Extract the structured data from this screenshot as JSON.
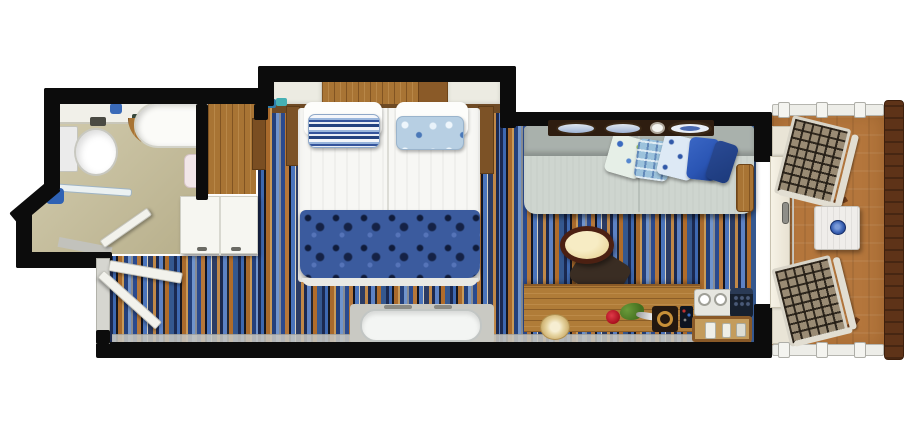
{
  "title": "Balcony stateroom floor plan",
  "rooms": [
    {
      "id": "bathroom",
      "label": "Bathroom"
    },
    {
      "id": "closet",
      "label": "Closet and wardrobe"
    },
    {
      "id": "entry",
      "label": "Entry hallway"
    },
    {
      "id": "bedroom",
      "label": "Bedroom with twin beds"
    },
    {
      "id": "sitting_area",
      "label": "Sitting area"
    },
    {
      "id": "balcony",
      "label": "Private balcony"
    }
  ],
  "labels": {
    "floor_plan": "Stateroom floor plan",
    "bathroom": "Bathroom",
    "sink_counter": "Sink counter",
    "faucet": "Faucet",
    "bathtub": "Bathtub shower",
    "toilet": "Toilet",
    "towel": "Towel",
    "shower_screen": "Glass shower screen",
    "shower_head": "Shower head",
    "bathroom_door": "Bathroom door",
    "closet_floor": "Closet wood floor",
    "wardrobe": "Wardrobe cabinet",
    "entry": "Entry hallway",
    "entry_door": "Entry door",
    "bedroom": "Bedroom",
    "bed": "Twin beds with duvet",
    "headboard": "Wood headboard",
    "shelf": "Bedside shelf",
    "nightstand": "Nightstand",
    "pillow_striped": "Striped pillow",
    "pillow_floral": "Floral pillow",
    "bed_runner": "Patterned bed runner",
    "bench": "Bench seat",
    "sitting_area": "Sitting area",
    "sofa": "Sofa",
    "sofa_armrest": "Sofa wood armrest",
    "wall_plates": "Decorative wall plates",
    "sofa_pillows": "Decorative sofa pillows",
    "desk_chair": "Desk chair",
    "desk": "Writing desk",
    "sun_hat": "Sun hat",
    "rose": "Rose in vase",
    "picture_frame": "Framed picture",
    "remote": "Remote control",
    "tea_tray": "Tea tray with cups",
    "telephone": "Telephone",
    "minibar_tray": "Minibar tray with bottles",
    "sliding_door": "Sliding balcony door",
    "door_handle": "Door handle",
    "balcony": "Private balcony",
    "balcony_floor": "Balcony deck",
    "railing": "Balcony railing",
    "wood_railing": "Wood side railing",
    "lounge_chair": "Webbed lounge chair",
    "balcony_table": "Balcony table",
    "bowl": "Blue bowl"
  },
  "colors": {
    "wall": "#0c0c0c",
    "bathroom_floor": "#c6bd96",
    "carpet_blue": "#3e68b0",
    "carpet_navy": "#1b2950",
    "carpet_orange": "#b06c2a",
    "carpet_tan": "#c99a58",
    "wood": "#a87434",
    "dark_wood": "#6e4a24",
    "balcony_floor": "#b4763c",
    "railing_wood": "#5e3318",
    "sofa": "#ced5cf",
    "bed_linen": "#f7f7f4",
    "bed_runner": "#3b5b9e",
    "accent_blue": "#2a55b4",
    "terracotta_bowl_blue": "#3a62b4"
  }
}
